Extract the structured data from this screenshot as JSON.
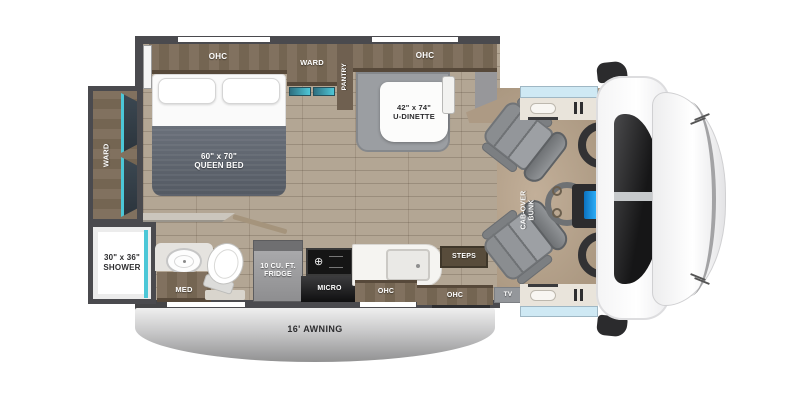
{
  "colors": {
    "wall": "#4a4a4e",
    "cabinet_wood": "#7c6c5a",
    "floor_wood": "#b3a694",
    "cab_floor_tan": "#b5a28b",
    "accent_teal": "#4cc7d7",
    "bed_duvet": "#5d636c",
    "seat_gray": "#8e9194",
    "awning_silver": "#c6c6c7",
    "dash_screen_blue": "#2ab0f5",
    "windshield_glass": "#1c1c1d",
    "door_window_glass": "#cfe9f4"
  },
  "floorplan": {
    "bedroom": {
      "ohc_label": "OHC",
      "ward_label": "WARD",
      "pantry_label": "PANTRY",
      "bed_size": "60\" x 70\"",
      "bed_name": "QUEEN BED"
    },
    "rear": {
      "ward_label": "WARD"
    },
    "dinette": {
      "ohc_label": "OHC",
      "size": "42\" x 74\"",
      "name": "U-DINETTE"
    },
    "bath": {
      "shower_size": "30\" x 36\"",
      "shower_name": "SHOWER",
      "med_label": "MED"
    },
    "kitchen": {
      "fridge_line1": "10 CU. FT.",
      "fridge_line2": "FRIDGE",
      "micro_label": "MICRO",
      "ohc_label": "OHC"
    },
    "entry": {
      "ohc_label": "OHC",
      "steps_label": "STEPS",
      "tv_label": "TV"
    },
    "cab": {
      "bunk_line1": "CAB-OVER",
      "bunk_line2": "BUNK"
    },
    "exterior": {
      "awning_label": "16' AWNING"
    }
  }
}
